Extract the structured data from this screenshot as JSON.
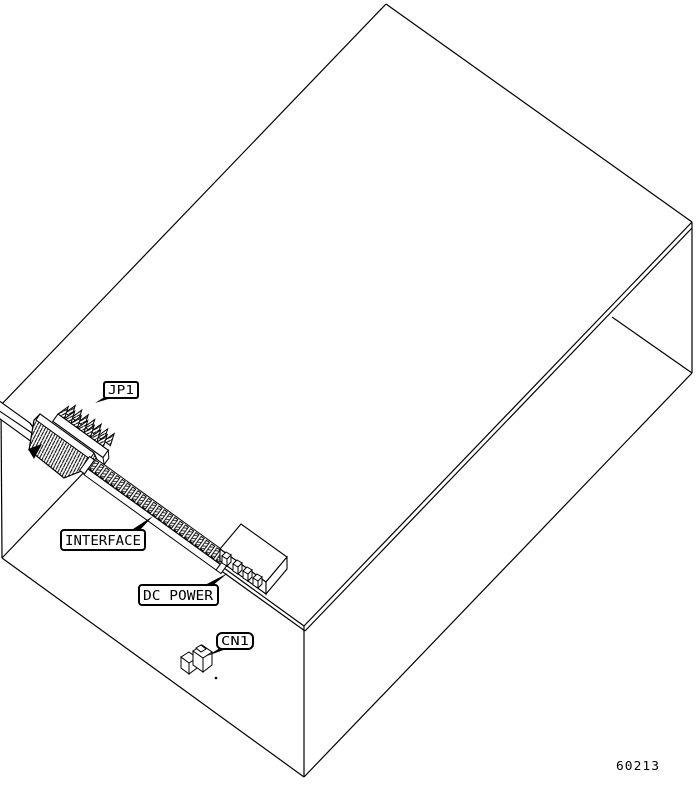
{
  "figure": {
    "kind": "isometric-line-drawing",
    "subject": "chassis-with-edge-connectors",
    "colors": {
      "line": "#000000",
      "background": "#ffffff"
    },
    "callouts": {
      "jp1": {
        "label": "JP1"
      },
      "interface": {
        "label": "INTERFACE"
      },
      "dc_power": {
        "label": "DC POWER"
      },
      "cn1": {
        "label": "CN1"
      }
    },
    "figure_number": "60213"
  }
}
